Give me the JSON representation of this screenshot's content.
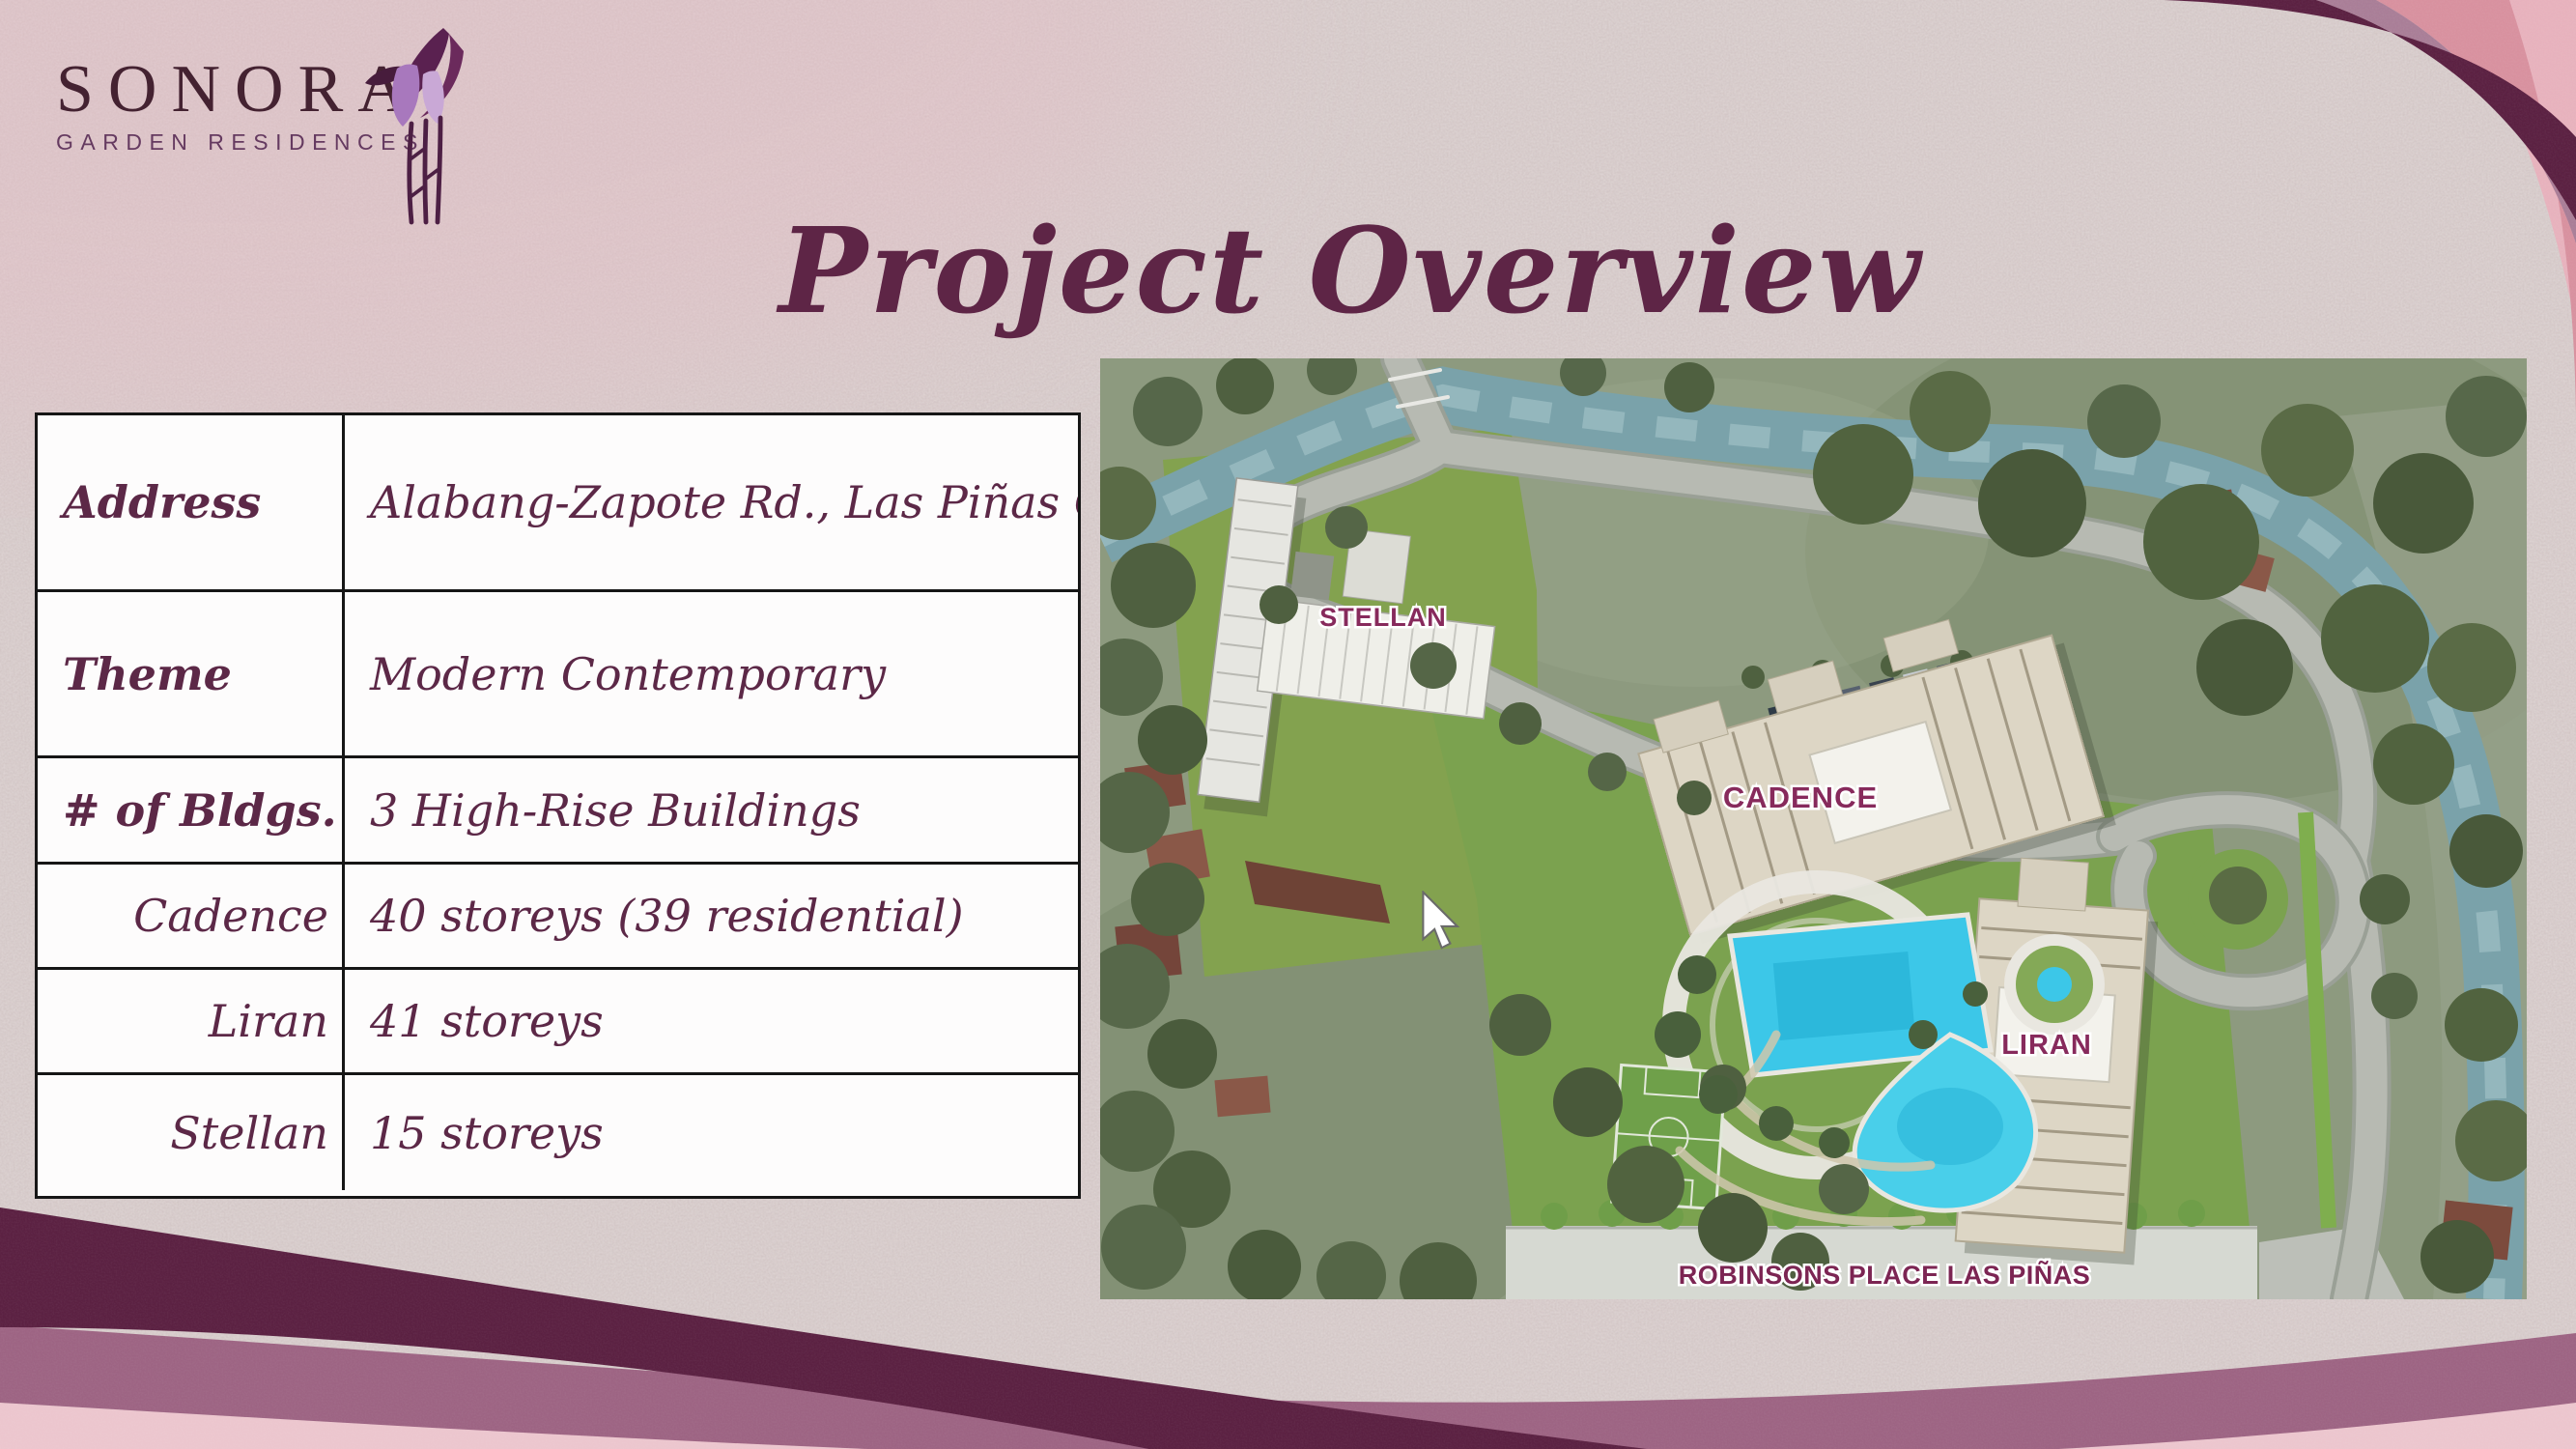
{
  "logo": {
    "name": "SONORA",
    "tagline": "GARDEN RESIDENCES"
  },
  "title": "Project Overview",
  "table": {
    "rows": [
      {
        "label": "Address",
        "value": "Alabang-Zapote Rd., Las Piñas City"
      },
      {
        "label": "Theme",
        "value": "Modern Contemporary"
      },
      {
        "label": "# of Bldgs.",
        "value": "3 High-Rise Buildings"
      },
      {
        "label": "Cadence",
        "value": "40 storeys (39 residential)"
      },
      {
        "label": "Liran",
        "value": "41 storeys"
      },
      {
        "label": "Stellan",
        "value": "15 storeys"
      }
    ]
  },
  "map": {
    "labels": {
      "stellan": "STELLAN",
      "cadence": "CADENCE",
      "liran": "LIRAN",
      "robinsons": "ROBINSONS PLACE LAS PIÑAS"
    }
  },
  "colors": {
    "background": "#d5c9c8",
    "title_maroon": "#5e2546",
    "table_text": "#5c2847",
    "band_dark": "#5b2142",
    "band_mauve": "#9d6483",
    "band_pink": "#ecc6ce",
    "band_rose": "#d8919f",
    "corner_pink": "#e7b2bd",
    "map_label": "#872a5c",
    "pool_cyan": "#3cc7e8"
  }
}
